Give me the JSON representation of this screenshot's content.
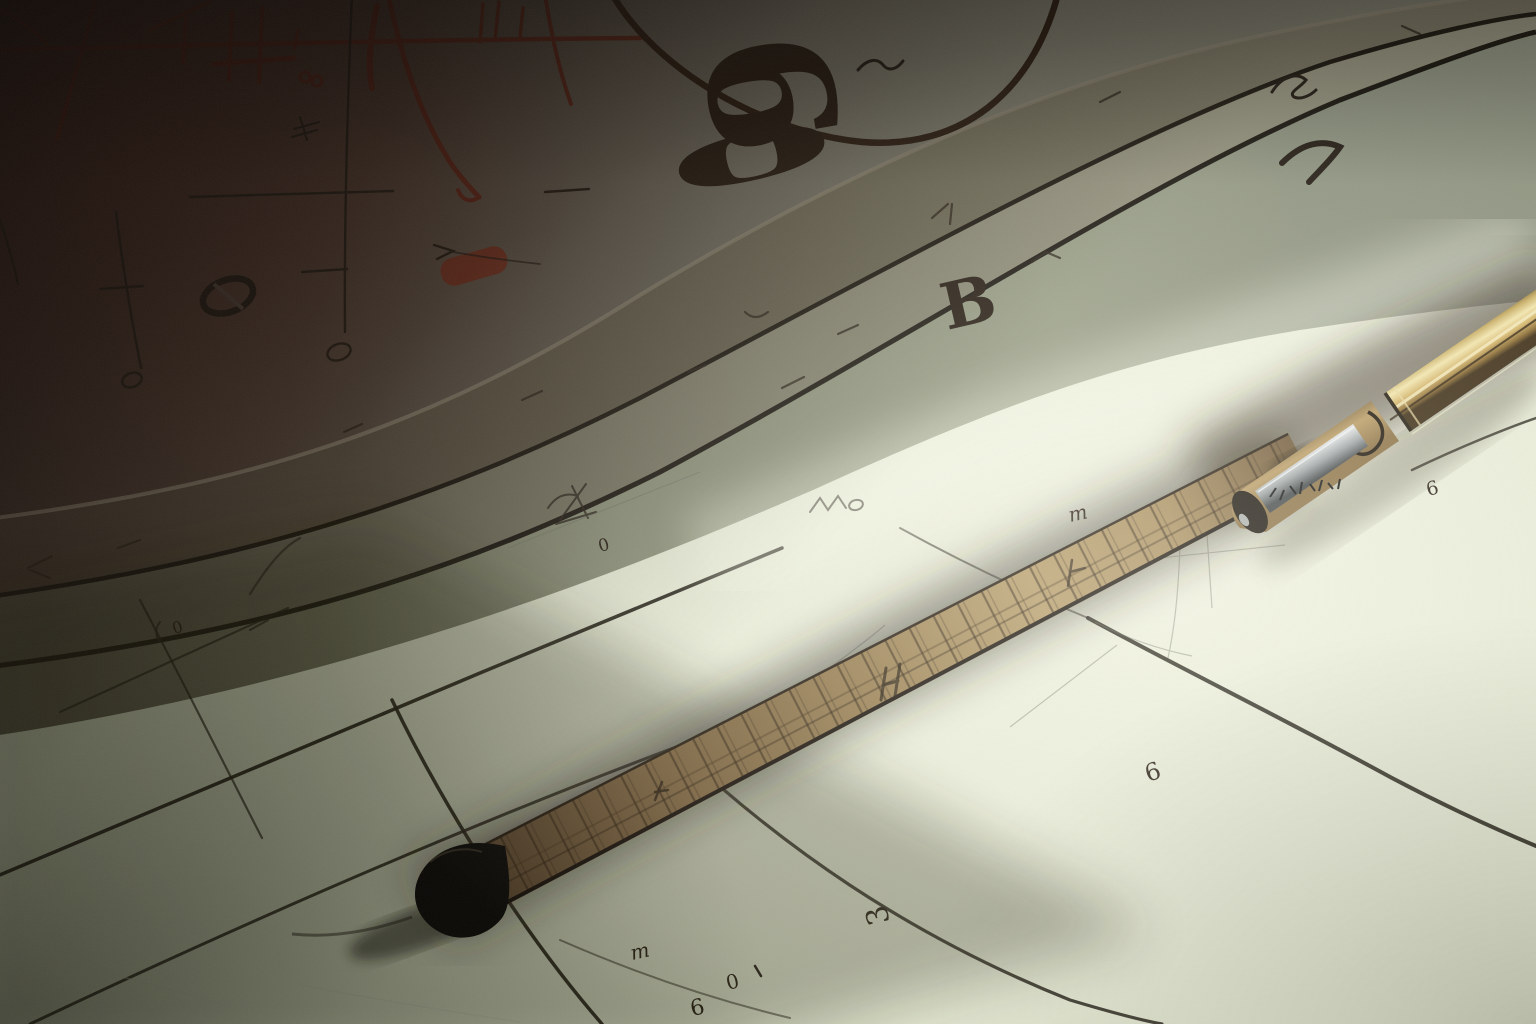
{
  "scene": {
    "description": "Illustrated close-up of a drafting table: a dark sketch sheet covered in red and black mathematical doodles, stacked straightedge bands, pale squared paper with handwritten digits, a segmented wooden measuring tape with a black end cap, and a brass pen with an engraved silver clip.",
    "objects": [
      {
        "name": "sketch-paper",
        "label": "dark sketch sheet with red axes and the figure 60"
      },
      {
        "name": "straightedge-bands",
        "label": "stacked ruler edges with tick scribbles"
      },
      {
        "name": "grid-paper",
        "label": "pale green squared paper with handwritten digits"
      },
      {
        "name": "measuring-tape",
        "label": "segmented wooden tape with black end cap"
      },
      {
        "name": "pen",
        "label": "brass pen with engraved metal clip"
      }
    ]
  },
  "handwriting": {
    "big_six": "6",
    "big_zero": "0",
    "letter_b": "B",
    "band_zero": "0",
    "band_m": "m",
    "band_six": "6",
    "cell_six": "6",
    "bottom_m": "m",
    "bottom_zero": "0",
    "bottom_six": "6",
    "bottom_three": "3",
    "left_zero": "0"
  },
  "palette": {
    "paper_bright": "#eef0de",
    "paper_mid": "#dde3cb",
    "band_olive": "#8f9480",
    "shadow_brown": "#2c211b",
    "ink_red": "#5c2012",
    "ink_dark": "#241d15",
    "tape_wood": "#a98f5f",
    "tape_cap": "#0b0906",
    "pen_brass": "#f2e5ac",
    "pen_clip_silver": "#cfd4d6"
  }
}
